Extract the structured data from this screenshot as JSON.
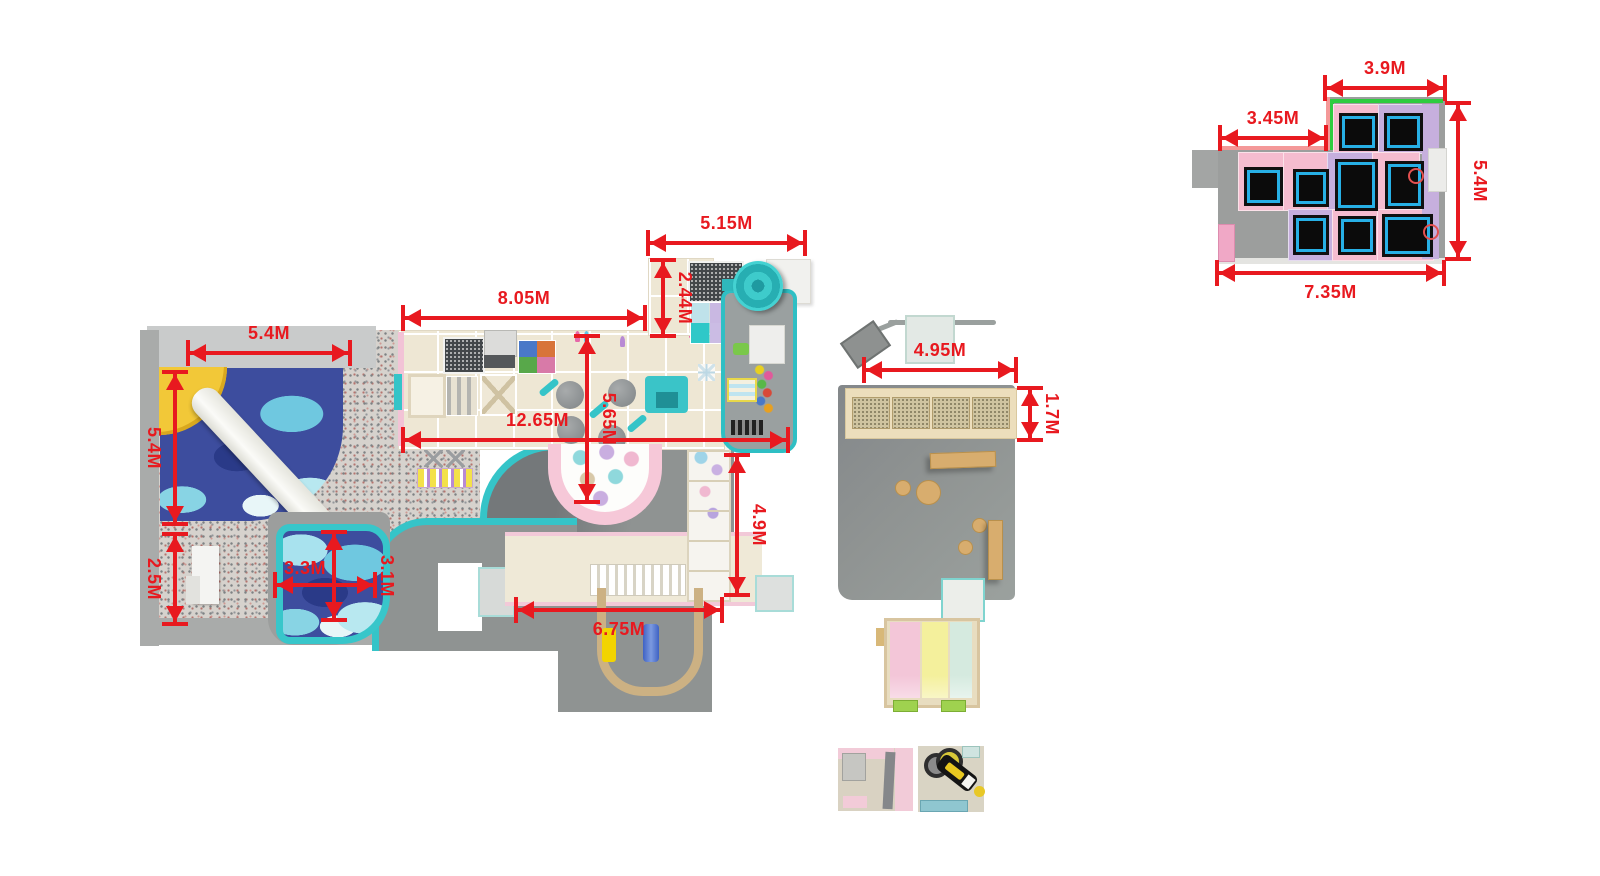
{
  "plan": {
    "type": "indoor-playground-floor-plan-top-view",
    "units": "meters"
  },
  "dimensions": {
    "ball_pit_width": "5.4M",
    "ball_pit_depth": "5.4M",
    "reception_depth": "2.5M",
    "toddler_pool_width": "3.3M",
    "toddler_pool_depth": "3.1M",
    "upper_deck_width": "8.05M",
    "total_length": "12.65M",
    "deck_depth": "5.65M",
    "top_platform_width": "5.15M",
    "top_platform_depth": "2.44M",
    "right_wing_depth": "4.9M",
    "walkway_width": "6.75M",
    "party_room_width": "4.95M",
    "party_room_depth": "1.7M",
    "trampoline_top_width": "3.9M",
    "trampoline_notch_width": "3.45M",
    "trampoline_depth": "5.4M",
    "trampoline_total_width": "7.35M"
  },
  "colors": {
    "dimension_red": "#e8191f",
    "teal_border": "#35c4c8",
    "cream_deck": "#eee7d4",
    "floor_gray": "#8f9392",
    "trampoline_pink": "#f5bccf",
    "trampoline_lavender": "#c6afdd",
    "trampoline_frame_cyan": "#27b0e6",
    "safety_green": "#2ecc40",
    "ballpit_blue": "#3d4d9e",
    "slide_pink": "#f3c6d8",
    "slide_yellow": "#f4f09c",
    "slide_mint": "#d5eadf"
  }
}
